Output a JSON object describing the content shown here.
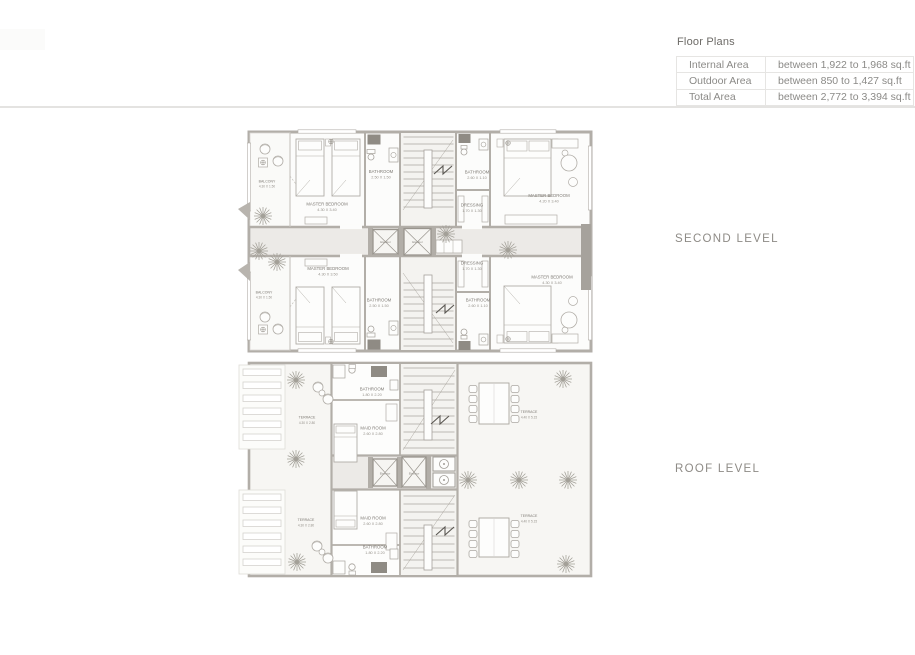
{
  "area_table": {
    "title": "Floor Plans",
    "rows": [
      {
        "label": "Internal Area",
        "value": "between 1,922 to 1,968 sq.ft"
      },
      {
        "label": "Outdoor Area",
        "value": "between 850 to 1,427 sq.ft"
      },
      {
        "label": "Total Area",
        "value": "between 2,772 to 3,394 sq.ft"
      }
    ]
  },
  "plans": {
    "second": {
      "title": "SECOND LEVEL",
      "elevator": "Elevator",
      "rooms": {
        "balcony_top": {
          "name": "BALCONY",
          "dims": "4.30 X 1.50"
        },
        "master_top_left": {
          "name": "MASTER BEDROOM",
          "dims": "4.30 X 3.40"
        },
        "bath_top_center": {
          "name": "BATHROOM",
          "dims": "2.50 X 1.50"
        },
        "bath_top_right": {
          "name": "BATHROOM",
          "dims": "2.60 X 1.10"
        },
        "dressing_top": {
          "name": "DRESSING",
          "dims": "1.70 X 1.30"
        },
        "master_top_right": {
          "name": "MASTER BEDROOM",
          "dims": "4.20 X 3.40"
        },
        "balcony_bottom": {
          "name": "BALCONY",
          "dims": "4.30 X 1.50"
        },
        "master_bottom_left": {
          "name": "MASTER BEDROOM",
          "dims": "4.30 X 3.50"
        },
        "bath_bottom_center": {
          "name": "BATHROOM",
          "dims": "2.50 X 1.50"
        },
        "bath_bottom_right": {
          "name": "BATHROOM",
          "dims": "2.60 X 1.10"
        },
        "dressing_bottom": {
          "name": "DRESSING",
          "dims": "1.70 X 1.30"
        },
        "master_bottom_right": {
          "name": "MASTER BEDROOM",
          "dims": "4.30 X 3.40"
        }
      }
    },
    "roof": {
      "title": "ROOF LEVEL",
      "elevator": "Elevator",
      "rooms": {
        "terrace_top_left": {
          "name": "TERRACE",
          "dims": "4.30 X 2.80"
        },
        "bath_top": {
          "name": "BATHROOM",
          "dims": "1.80 X 2.20"
        },
        "maid_top": {
          "name": "MAID ROOM",
          "dims": "2.60 X 2.80"
        },
        "terrace_top_right": {
          "name": "TERRACE",
          "dims": "4.40 X 5.15"
        },
        "terrace_bottom_left": {
          "name": "TERRACE",
          "dims": "4.30 X 2.80"
        },
        "maid_bottom": {
          "name": "MAID ROOM",
          "dims": "2.60 X 2.80"
        },
        "bath_bottom": {
          "name": "BATHROOM",
          "dims": "1.80 X 2.20"
        },
        "terrace_bottom_right": {
          "name": "TERRACE",
          "dims": "4.40 X 5.15"
        }
      }
    }
  }
}
